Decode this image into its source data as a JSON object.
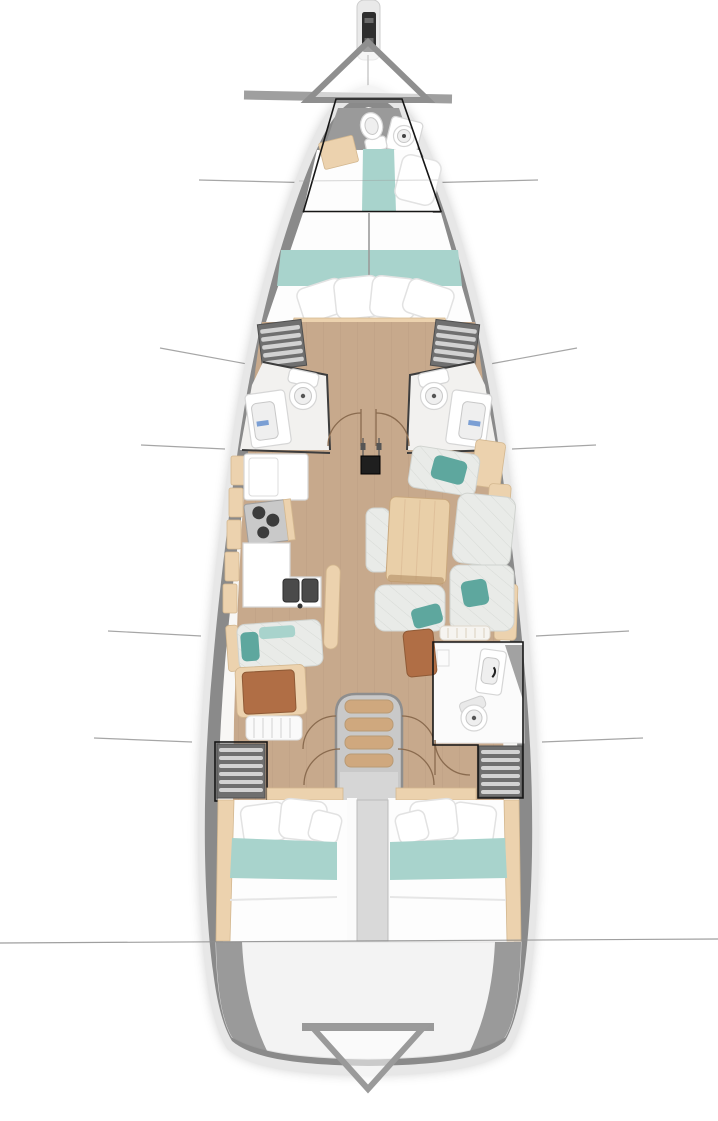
{
  "document": {
    "kind": "sailing-yacht-interior-deck-plan",
    "view": "top-down floor plan, bow at top",
    "width_px": 718,
    "height_px": 1121,
    "visible_text": "none"
  },
  "palette": {
    "hull_outer": "#e7e7e7",
    "hull_deck": "#8a8a8a",
    "interior": "#f8f7f5",
    "wood_floor": "#c7a98c",
    "wood_plank": "#b2947a",
    "wood_light": "#ecd2ae",
    "wood_table": "#e9cfa8",
    "teal": "#a8d3cc",
    "teal_dark": "#5ea79e",
    "cushion": "#e9ebe8",
    "cushion_line": "#d7dad6",
    "brown_leather": "#b06e45",
    "locker_grey": "#6f6f6f",
    "locker_slat": "#d2d2d2",
    "outline_black": "#161616",
    "callout_line": "#a6a6a6",
    "steps_tread": "#cfa87e",
    "steel_grey": "#c7c7c7",
    "transom_grey": "#f3f3f3",
    "berth_white": "#fdfdfd"
  },
  "markers": {
    "bow_triangle": "upward hollow triangle over bow with grey shadow bar",
    "stern_triangle": "downward hollow triangle on transom",
    "option_boxes": "thin black outlines around forepeak berth, starboard aft head + locker, port aft locker",
    "section_lines_count": 6,
    "full_width_section_lines": 2
  },
  "areas": [
    {
      "name": "bowsprit-anchor-fitting",
      "features": [
        "windlass-black-fitting"
      ]
    },
    {
      "name": "forepeak-head",
      "features": [
        "toilet",
        "round-washer-hatch",
        "wood-storage-box"
      ],
      "highlighted": true
    },
    {
      "name": "forepeak-berth",
      "features": [
        "white-duvet",
        "teal-runner",
        "pillow"
      ],
      "highlighted": true
    },
    {
      "name": "forward-v-berth",
      "features": [
        "white-duvet",
        "teal-band",
        "four-pillows",
        "center-seam",
        "wood-footboard"
      ]
    },
    {
      "name": "port-hanging-locker",
      "features": [
        "shelf-slats"
      ]
    },
    {
      "name": "starboard-hanging-locker",
      "features": [
        "shelf-slats"
      ]
    },
    {
      "name": "port-head",
      "features": [
        "toilet",
        "sink-vanity",
        "door-swing-arc"
      ]
    },
    {
      "name": "starboard-head",
      "features": [
        "toilet",
        "sink-vanity",
        "door-swing-arc"
      ]
    },
    {
      "name": "galley-port",
      "features": [
        "fridge-counter",
        "stove-three-burners",
        "lower-counter",
        "double-sink",
        "wood-handrail",
        "hull-shelf-panels"
      ]
    },
    {
      "name": "salon-starboard",
      "features": [
        "l-shaped-settee",
        "quilted-cushions",
        "three-teal-pillows",
        "wood-dining-table",
        "center-bench",
        "hull-backrest-panels"
      ]
    },
    {
      "name": "chart-station-port",
      "features": [
        "quilted-seat",
        "teal-pillow",
        "leather-top-desk",
        "slatted-bench"
      ]
    },
    {
      "name": "mast-post",
      "features": [
        "rigging-lines"
      ]
    },
    {
      "name": "companionway",
      "features": [
        "four-wood-treads",
        "grey-frame",
        "engine-column-to-stern"
      ]
    },
    {
      "name": "aft-head-starboard",
      "features": [
        "shower-glass",
        "sink",
        "toilet",
        "door-swing-arc"
      ],
      "highlighted": true
    },
    {
      "name": "aft-hanging-locker-starboard",
      "highlighted": true
    },
    {
      "name": "aft-hanging-locker-port",
      "highlighted": true
    },
    {
      "name": "port-aft-cabin",
      "features": [
        "double-berth",
        "pillows",
        "teal-band",
        "wood-hull-trim"
      ]
    },
    {
      "name": "starboard-aft-cabin",
      "features": [
        "double-berth",
        "pillows",
        "teal-band",
        "wood-hull-trim"
      ]
    },
    {
      "name": "transom-garage",
      "features": [
        "stern-triangle-marker"
      ]
    }
  ]
}
